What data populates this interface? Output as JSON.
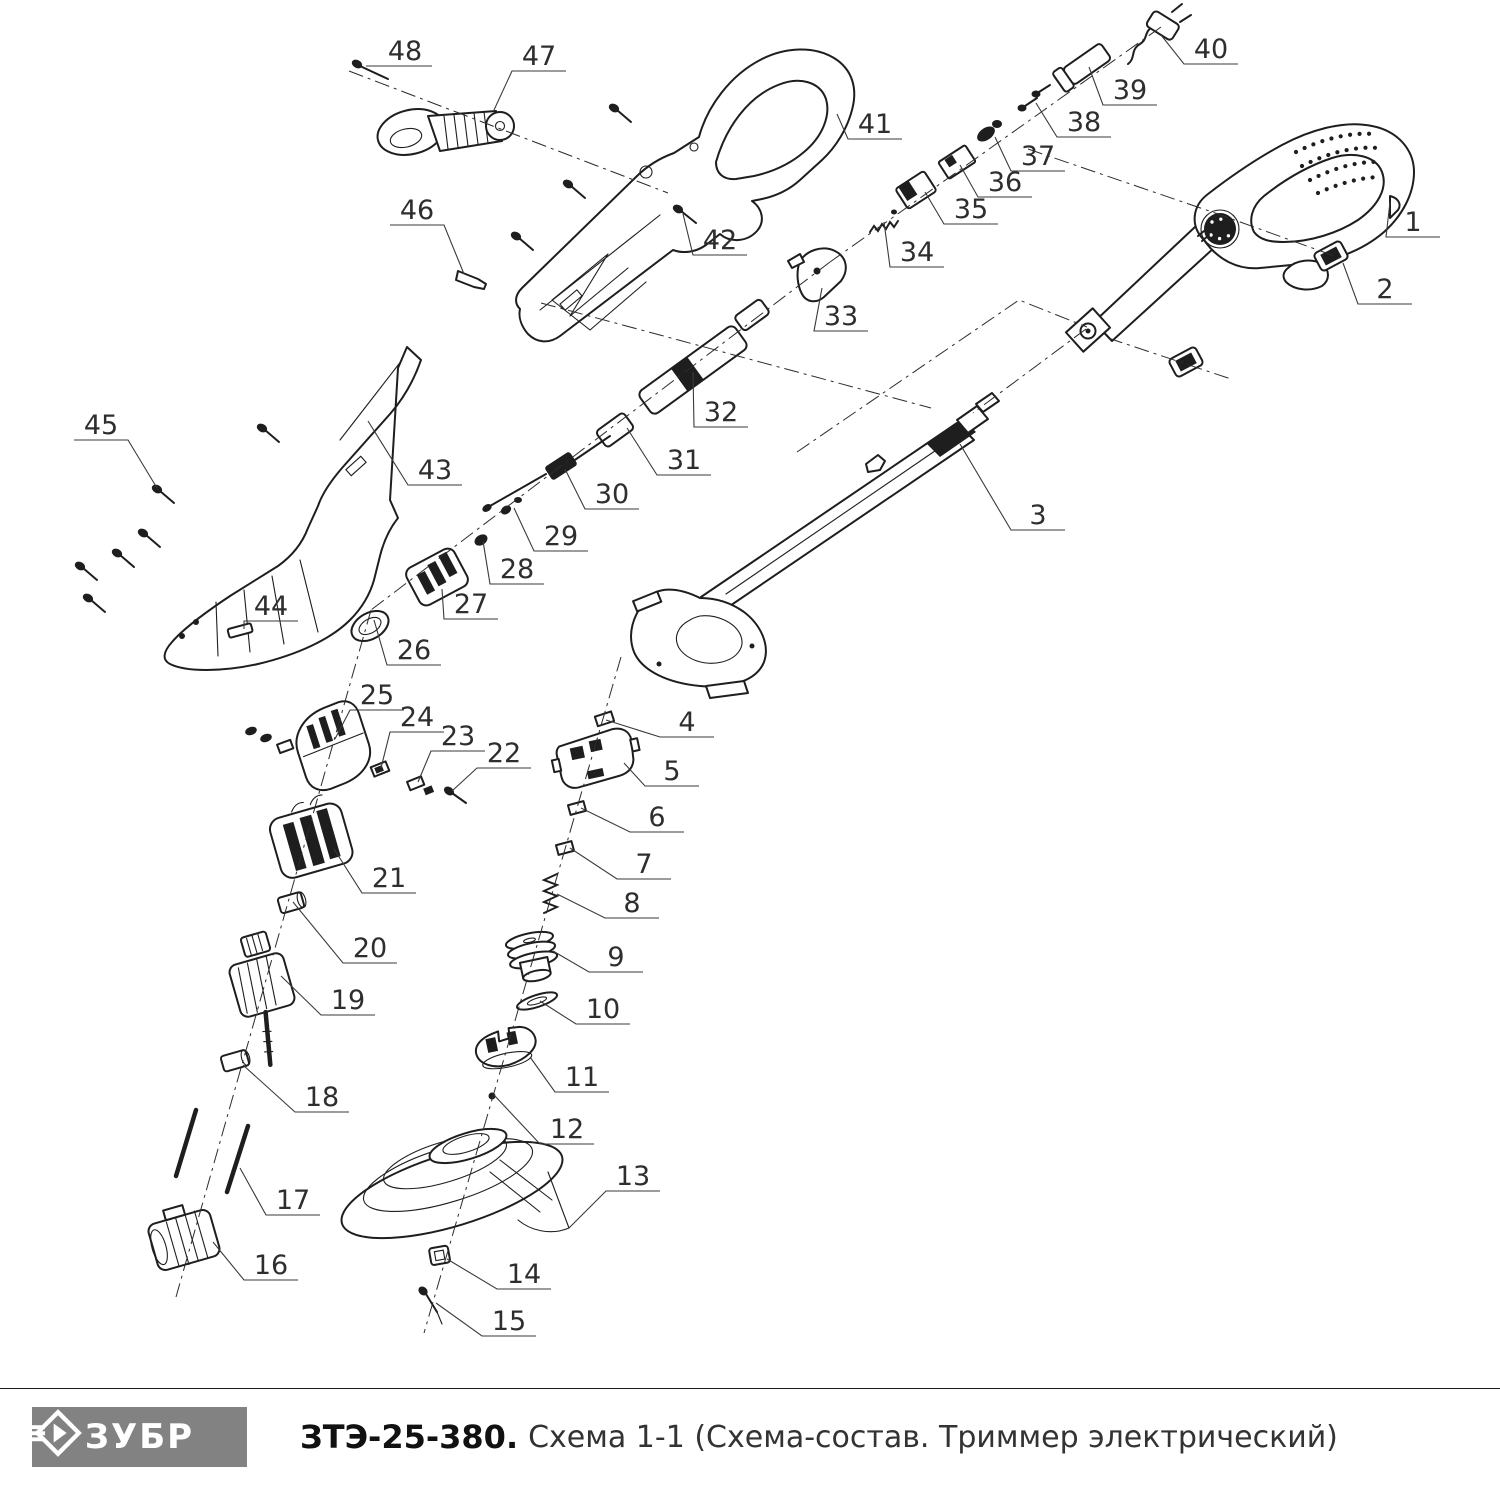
{
  "page": {
    "background": "#ffffff",
    "kind": "exploded parts diagram"
  },
  "footer": {
    "brand": "ЗУБР",
    "model": "ЗТЭ-25-380.",
    "scheme_title": "Схема 1-1 (Схема-состав. Триммер электрический)",
    "logo_bg": "#828282",
    "logo_fg": "#ffffff"
  },
  "diagram": {
    "description": "Exploded view of electric grass trimmer with numbered part callouts 1-48",
    "line_color": "#1e1e1e",
    "label_color": "#2e2e2e",
    "parts": [
      {
        "num": "1",
        "lx": 1413,
        "ly": 222,
        "tx": 1390,
        "ty": 202
      },
      {
        "num": "2",
        "lx": 1385,
        "ly": 289,
        "tx": 1343,
        "ty": 263
      },
      {
        "num": "3",
        "lx": 1038,
        "ly": 515,
        "tx": 960,
        "ty": 444
      },
      {
        "num": "4",
        "lx": 687,
        "ly": 722,
        "tx": 606,
        "ty": 720
      },
      {
        "num": "5",
        "lx": 672,
        "ly": 771,
        "tx": 624,
        "ty": 763
      },
      {
        "num": "6",
        "lx": 657,
        "ly": 817,
        "tx": 581,
        "ty": 808
      },
      {
        "num": "7",
        "lx": 644,
        "ly": 864,
        "tx": 570,
        "ty": 848
      },
      {
        "num": "8",
        "lx": 632,
        "ly": 903,
        "tx": 557,
        "ty": 894
      },
      {
        "num": "9",
        "lx": 616,
        "ly": 957,
        "tx": 553,
        "ty": 951
      },
      {
        "num": "10",
        "lx": 603,
        "ly": 1009,
        "tx": 540,
        "ty": 1001
      },
      {
        "num": "11",
        "lx": 582,
        "ly": 1077,
        "tx": 530,
        "ty": 1057
      },
      {
        "num": "12",
        "lx": 567,
        "ly": 1129,
        "tx": 494,
        "ty": 1095
      },
      {
        "num": "13",
        "lx": 633,
        "ly": 1176,
        "tx": 569,
        "ty": 1228
      },
      {
        "num": "14",
        "lx": 524,
        "ly": 1274,
        "tx": 447,
        "ty": 1259
      },
      {
        "num": "15",
        "lx": 509,
        "ly": 1321,
        "tx": 436,
        "ty": 1303
      },
      {
        "num": "16",
        "lx": 271,
        "ly": 1265,
        "tx": 213,
        "ty": 1242
      },
      {
        "num": "17",
        "lx": 293,
        "ly": 1200,
        "tx": 240,
        "ty": 1168
      },
      {
        "num": "18",
        "lx": 322,
        "ly": 1097,
        "tx": 243,
        "ty": 1065
      },
      {
        "num": "19",
        "lx": 348,
        "ly": 1000,
        "tx": 281,
        "ty": 976
      },
      {
        "num": "20",
        "lx": 370,
        "ly": 948,
        "tx": 293,
        "ty": 902
      },
      {
        "num": "21",
        "lx": 389,
        "ly": 878,
        "tx": 334,
        "ty": 849
      },
      {
        "num": "22",
        "lx": 504,
        "ly": 753,
        "tx": 452,
        "ty": 791
      },
      {
        "num": "23",
        "lx": 458,
        "ly": 736,
        "tx": 418,
        "ty": 782
      },
      {
        "num": "24",
        "lx": 417,
        "ly": 717,
        "tx": 381,
        "ty": 768
      },
      {
        "num": "25",
        "lx": 377,
        "ly": 695,
        "tx": 335,
        "ty": 739
      },
      {
        "num": "26",
        "lx": 414,
        "ly": 650,
        "tx": 374,
        "ty": 620
      },
      {
        "num": "27",
        "lx": 471,
        "ly": 604,
        "tx": 442,
        "ty": 589
      },
      {
        "num": "28",
        "lx": 517,
        "ly": 569,
        "tx": 483,
        "ty": 541
      },
      {
        "num": "29",
        "lx": 561,
        "ly": 536,
        "tx": 514,
        "ty": 508
      },
      {
        "num": "30",
        "lx": 612,
        "ly": 494,
        "tx": 565,
        "ty": 469
      },
      {
        "num": "31",
        "lx": 684,
        "ly": 460,
        "tx": 627,
        "ty": 428
      },
      {
        "num": "32",
        "lx": 721,
        "ly": 412,
        "tx": 693,
        "ty": 372
      },
      {
        "num": "33",
        "lx": 841,
        "ly": 316,
        "tx": 822,
        "ty": 288
      },
      {
        "num": "34",
        "lx": 917,
        "ly": 252,
        "tx": 884,
        "ty": 222
      },
      {
        "num": "35",
        "lx": 971,
        "ly": 209,
        "tx": 925,
        "ty": 192
      },
      {
        "num": "36",
        "lx": 1005,
        "ly": 182,
        "tx": 960,
        "ty": 165
      },
      {
        "num": "37",
        "lx": 1038,
        "ly": 156,
        "tx": 995,
        "ty": 137
      },
      {
        "num": "38",
        "lx": 1084,
        "ly": 122,
        "tx": 1036,
        "ty": 103
      },
      {
        "num": "39",
        "lx": 1130,
        "ly": 90,
        "tx": 1089,
        "ty": 67
      },
      {
        "num": "40",
        "lx": 1211,
        "ly": 49,
        "tx": 1161,
        "ty": 35
      },
      {
        "num": "41",
        "lx": 875,
        "ly": 124,
        "tx": 837,
        "ty": 114
      },
      {
        "num": "42",
        "lx": 720,
        "ly": 240,
        "tx": 683,
        "ty": 214
      },
      {
        "num": "43",
        "lx": 435,
        "ly": 470,
        "tx": 368,
        "ty": 421
      },
      {
        "num": "44",
        "lx": 271,
        "ly": 606,
        "tx": 244,
        "ty": 629
      },
      {
        "num": "45",
        "lx": 101,
        "ly": 425,
        "tx": 157,
        "ty": 488
      },
      {
        "num": "46",
        "lx": 417,
        "ly": 210,
        "tx": 464,
        "ty": 274
      },
      {
        "num": "47",
        "lx": 539,
        "ly": 56,
        "tx": 494,
        "ty": 110
      },
      {
        "num": "48",
        "lx": 405,
        "ly": 51,
        "tx": 366,
        "ty": 66
      }
    ],
    "axes": [
      {
        "name": "aux-handle-axis",
        "points": "349,71 668,193"
      },
      {
        "name": "switch-train-axis",
        "points": "1161,27 830,262"
      },
      {
        "name": "drive-train-axis",
        "points": "830,262 371,610"
      },
      {
        "name": "motor-column-axis",
        "points": "371,610 176,1297"
      },
      {
        "name": "head-column-axis",
        "points": "621,657 424,1333"
      },
      {
        "name": "boom-axis",
        "points": "1086,329 973,413"
      },
      {
        "name": "hinge-axis",
        "points": "797,452 1019,300 1087,327"
      },
      {
        "name": "shell-align-axis",
        "points": "541,303 931,408"
      },
      {
        "name": "cord-upper-axis",
        "points": "1028,149 1218,214 1340,258"
      },
      {
        "name": "cord-lower-axis",
        "points": "1108,338 1231,379"
      }
    ]
  }
}
